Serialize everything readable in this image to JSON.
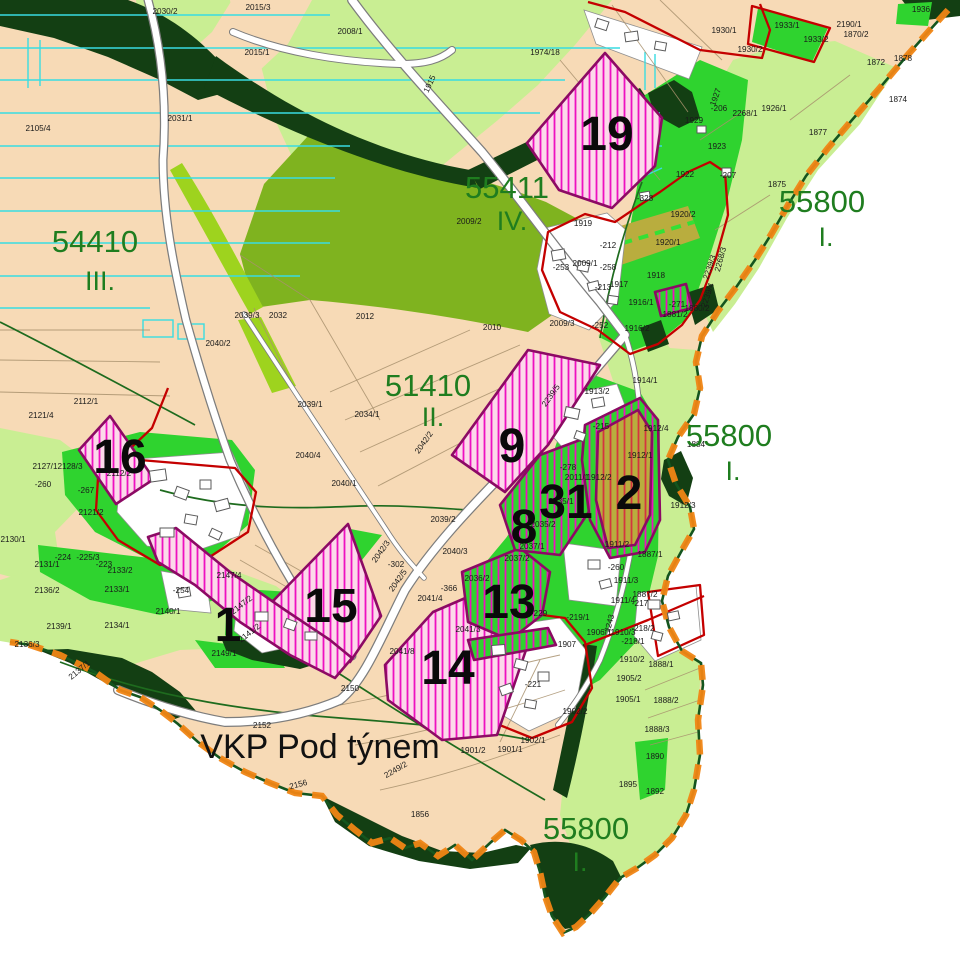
{
  "map": {
    "area_label": {
      "text": "VKP Pod týnem",
      "x": 320,
      "y": 758
    },
    "region_labels": [
      {
        "code": "54410",
        "roman": "III.",
        "x": 95,
        "y": 252,
        "rx": 100,
        "ry": 290
      },
      {
        "code": "55411",
        "roman": "IV.",
        "x": 507,
        "y": 198,
        "rx": 512,
        "ry": 230
      },
      {
        "code": "51410",
        "roman": "II.",
        "x": 428,
        "y": 396,
        "rx": 433,
        "ry": 426
      },
      {
        "code": "55800",
        "roman": "I.",
        "x": 822,
        "y": 212,
        "rx": 826,
        "ry": 246
      },
      {
        "code": "55800",
        "roman": "I.",
        "x": 729,
        "y": 446,
        "rx": 733,
        "ry": 480
      },
      {
        "code": "55800",
        "roman": "I.",
        "x": 586,
        "y": 839,
        "rx": 580,
        "ry": 871
      }
    ],
    "site_numbers": [
      {
        "n": "19",
        "x": 607,
        "y": 150
      },
      {
        "n": "16",
        "x": 120,
        "y": 473
      },
      {
        "n": "9",
        "x": 512,
        "y": 462
      },
      {
        "n": "8",
        "x": 524,
        "y": 543
      },
      {
        "n": "31",
        "x": 566,
        "y": 518
      },
      {
        "n": "2",
        "x": 629,
        "y": 509
      },
      {
        "n": "13",
        "x": 509,
        "y": 618
      },
      {
        "n": "15",
        "x": 331,
        "y": 622
      },
      {
        "n": "1",
        "x": 228,
        "y": 641
      },
      {
        "n": "14",
        "x": 448,
        "y": 684
      }
    ],
    "parcel_labels": [
      {
        "t": "2030/2",
        "x": 165,
        "y": 14
      },
      {
        "t": "2015/3",
        "x": 258,
        "y": 10
      },
      {
        "t": "2008/1",
        "x": 350,
        "y": 34
      },
      {
        "t": "2015/1",
        "x": 257,
        "y": 55
      },
      {
        "t": "1974/18",
        "x": 545,
        "y": 55
      },
      {
        "t": "2105/4",
        "x": 38,
        "y": 131
      },
      {
        "t": "2031/1",
        "x": 180,
        "y": 121
      },
      {
        "t": "1915",
        "x": 432,
        "y": 85,
        "r": -65
      },
      {
        "t": "1930/1",
        "x": 724,
        "y": 33
      },
      {
        "t": "1933/1",
        "x": 787,
        "y": 28
      },
      {
        "t": "1933/2",
        "x": 816,
        "y": 42
      },
      {
        "t": "1930/2",
        "x": 750,
        "y": 52
      },
      {
        "t": "1936",
        "x": 921,
        "y": 12
      },
      {
        "t": "2190/1",
        "x": 849,
        "y": 27
      },
      {
        "t": "1870/2",
        "x": 856,
        "y": 37
      },
      {
        "t": "1872",
        "x": 876,
        "y": 65
      },
      {
        "t": "1878",
        "x": 903,
        "y": 61
      },
      {
        "t": "1874",
        "x": 898,
        "y": 102
      },
      {
        "t": "1926/1",
        "x": 774,
        "y": 111
      },
      {
        "t": "1877",
        "x": 818,
        "y": 135
      },
      {
        "t": "1875",
        "x": 777,
        "y": 187
      },
      {
        "t": "-206",
        "x": 719,
        "y": 111
      },
      {
        "t": "2268/1",
        "x": 745,
        "y": 116
      },
      {
        "t": "1929",
        "x": 694,
        "y": 123
      },
      {
        "t": "1927",
        "x": 718,
        "y": 98,
        "r": -70
      },
      {
        "t": "1923",
        "x": 717,
        "y": 149
      },
      {
        "t": "1922",
        "x": 685,
        "y": 177
      },
      {
        "t": "-207",
        "x": 728,
        "y": 178
      },
      {
        "t": "-328",
        "x": 645,
        "y": 201
      },
      {
        "t": "1920/2",
        "x": 683,
        "y": 217
      },
      {
        "t": "1920/1",
        "x": 668,
        "y": 245
      },
      {
        "t": "1918",
        "x": 656,
        "y": 278
      },
      {
        "t": "1917",
        "x": 619,
        "y": 287
      },
      {
        "t": "-213",
        "x": 603,
        "y": 290
      },
      {
        "t": "-212",
        "x": 608,
        "y": 248
      },
      {
        "t": "-253",
        "x": 561,
        "y": 270
      },
      {
        "t": "2009/1",
        "x": 585,
        "y": 266
      },
      {
        "t": "-258",
        "x": 608,
        "y": 270
      },
      {
        "t": "1919",
        "x": 583,
        "y": 226
      },
      {
        "t": "1916/1",
        "x": 641,
        "y": 305
      },
      {
        "t": "-271",
        "x": 677,
        "y": 307
      },
      {
        "t": "1881/2",
        "x": 675,
        "y": 317
      },
      {
        "t": "1880/2",
        "x": 697,
        "y": 311
      },
      {
        "t": "-252",
        "x": 600,
        "y": 328
      },
      {
        "t": "1916/2",
        "x": 637,
        "y": 331
      },
      {
        "t": "2009/3",
        "x": 562,
        "y": 326
      },
      {
        "t": "2009/2",
        "x": 469,
        "y": 224
      },
      {
        "t": "2012",
        "x": 365,
        "y": 319
      },
      {
        "t": "2032",
        "x": 278,
        "y": 318
      },
      {
        "t": "2039/3",
        "x": 247,
        "y": 318
      },
      {
        "t": "2010",
        "x": 492,
        "y": 330
      },
      {
        "t": "2034/1",
        "x": 367,
        "y": 417
      },
      {
        "t": "2040/1",
        "x": 344,
        "y": 486
      },
      {
        "t": "2040/2",
        "x": 218,
        "y": 346
      },
      {
        "t": "2112/1",
        "x": 86,
        "y": 404
      },
      {
        "t": "2121/4",
        "x": 41,
        "y": 418
      },
      {
        "t": "2039/1",
        "x": 310,
        "y": 407
      },
      {
        "t": "2040/4",
        "x": 308,
        "y": 458
      },
      {
        "t": "2127/1",
        "x": 45,
        "y": 469
      },
      {
        "t": "2128/3",
        "x": 70,
        "y": 469
      },
      {
        "t": "2112/2",
        "x": 119,
        "y": 476
      },
      {
        "t": "-260",
        "x": 43,
        "y": 487
      },
      {
        "t": "-267",
        "x": 86,
        "y": 493
      },
      {
        "t": "2121/2",
        "x": 91,
        "y": 515
      },
      {
        "t": "2130/1",
        "x": 13,
        "y": 542
      },
      {
        "t": "-224",
        "x": 63,
        "y": 560
      },
      {
        "t": "-225/3",
        "x": 88,
        "y": 560
      },
      {
        "t": "-223",
        "x": 104,
        "y": 567
      },
      {
        "t": "2131/1",
        "x": 47,
        "y": 567
      },
      {
        "t": "2133/2",
        "x": 120,
        "y": 573
      },
      {
        "t": "2133/1",
        "x": 117,
        "y": 592
      },
      {
        "t": "2136/2",
        "x": 47,
        "y": 593
      },
      {
        "t": "2134/1",
        "x": 117,
        "y": 628
      },
      {
        "t": "2139/1",
        "x": 59,
        "y": 629
      },
      {
        "t": "2136/3",
        "x": 27,
        "y": 647
      },
      {
        "t": "2137/1",
        "x": 81,
        "y": 672,
        "r": -40
      },
      {
        "t": "2147/4",
        "x": 229,
        "y": 578
      },
      {
        "t": "-254",
        "x": 181,
        "y": 593
      },
      {
        "t": "2140/1",
        "x": 168,
        "y": 614
      },
      {
        "t": "2147/2",
        "x": 243,
        "y": 607,
        "r": -38
      },
      {
        "t": "2141/2",
        "x": 251,
        "y": 635,
        "r": -38
      },
      {
        "t": "2149/1",
        "x": 224,
        "y": 656
      },
      {
        "t": "2150",
        "x": 350,
        "y": 691
      },
      {
        "t": "2152",
        "x": 262,
        "y": 728
      },
      {
        "t": "2156",
        "x": 299,
        "y": 787,
        "r": -15
      },
      {
        "t": "1856",
        "x": 420,
        "y": 817
      },
      {
        "t": "2042/2",
        "x": 426,
        "y": 444,
        "r": -55
      },
      {
        "t": "2039/2",
        "x": 443,
        "y": 522
      },
      {
        "t": "2042/3",
        "x": 383,
        "y": 553,
        "r": -55
      },
      {
        "t": "-302",
        "x": 396,
        "y": 567
      },
      {
        "t": "2040/3",
        "x": 455,
        "y": 554
      },
      {
        "t": "-366",
        "x": 449,
        "y": 591
      },
      {
        "t": "2041/4",
        "x": 430,
        "y": 601
      },
      {
        "t": "2041/3",
        "x": 468,
        "y": 632
      },
      {
        "t": "2041/8",
        "x": 402,
        "y": 654
      },
      {
        "t": "2035/2",
        "x": 543,
        "y": 527
      },
      {
        "t": "2035/1",
        "x": 561,
        "y": 504
      },
      {
        "t": "2037/1",
        "x": 532,
        "y": 549
      },
      {
        "t": "2037/2",
        "x": 517,
        "y": 561
      },
      {
        "t": "2036/2",
        "x": 477,
        "y": 581
      },
      {
        "t": "2239/5",
        "x": 553,
        "y": 397,
        "r": -55
      },
      {
        "t": "1913/2",
        "x": 597,
        "y": 394
      },
      {
        "t": "-215",
        "x": 601,
        "y": 429
      },
      {
        "t": "-278",
        "x": 568,
        "y": 470
      },
      {
        "t": "2011/1",
        "x": 577,
        "y": 480
      },
      {
        "t": "1912/2",
        "x": 599,
        "y": 480
      },
      {
        "t": "1912/4",
        "x": 656,
        "y": 431
      },
      {
        "t": "1912/1",
        "x": 640,
        "y": 458
      },
      {
        "t": "1914/1",
        "x": 645,
        "y": 383
      },
      {
        "t": "1884",
        "x": 696,
        "y": 447
      },
      {
        "t": "1912/3",
        "x": 683,
        "y": 508
      },
      {
        "t": "1887/1",
        "x": 650,
        "y": 557
      },
      {
        "t": "1887/2",
        "x": 645,
        "y": 597
      },
      {
        "t": "2239/3",
        "x": 712,
        "y": 268,
        "r": -72
      },
      {
        "t": "2239/4",
        "x": 710,
        "y": 296,
        "r": -72
      },
      {
        "t": "2268/3",
        "x": 723,
        "y": 260,
        "r": -75
      },
      {
        "t": "2042/5",
        "x": 400,
        "y": 582,
        "r": -55
      },
      {
        "t": "1888/1",
        "x": 661,
        "y": 667
      },
      {
        "t": "1888/2",
        "x": 666,
        "y": 703
      },
      {
        "t": "1888/3",
        "x": 657,
        "y": 732
      },
      {
        "t": "1890",
        "x": 655,
        "y": 759
      },
      {
        "t": "1892",
        "x": 655,
        "y": 794
      },
      {
        "t": "1895",
        "x": 628,
        "y": 787
      },
      {
        "t": "1905/1",
        "x": 628,
        "y": 702
      },
      {
        "t": "1905/2",
        "x": 629,
        "y": 681
      },
      {
        "t": "1910/2",
        "x": 632,
        "y": 662
      },
      {
        "t": "1910/3",
        "x": 623,
        "y": 635
      },
      {
        "t": "-218/1",
        "x": 633,
        "y": 644
      },
      {
        "t": "-218/2",
        "x": 643,
        "y": 631
      },
      {
        "t": "-217",
        "x": 640,
        "y": 606
      },
      {
        "t": "1911/4",
        "x": 623,
        "y": 603
      },
      {
        "t": "1911/3",
        "x": 626,
        "y": 583
      },
      {
        "t": "1911/2",
        "x": 617,
        "y": 547
      },
      {
        "t": "-260",
        "x": 616,
        "y": 570
      },
      {
        "t": "1906/1",
        "x": 599,
        "y": 635
      },
      {
        "t": "1907",
        "x": 567,
        "y": 647
      },
      {
        "t": "-229",
        "x": 539,
        "y": 616
      },
      {
        "t": "-219/1",
        "x": 578,
        "y": 620
      },
      {
        "t": "-221",
        "x": 533,
        "y": 687
      },
      {
        "t": "2243",
        "x": 612,
        "y": 624,
        "r": -75
      },
      {
        "t": "1902/2",
        "x": 575,
        "y": 714
      },
      {
        "t": "1902/1",
        "x": 533,
        "y": 743
      },
      {
        "t": "1901/2",
        "x": 473,
        "y": 753
      },
      {
        "t": "1901/1",
        "x": 510,
        "y": 752
      },
      {
        "t": "2249/2",
        "x": 397,
        "y": 772,
        "r": -30
      }
    ],
    "colors": {
      "beige": "#f7dab6",
      "light_green": "#c9ee93",
      "mid_green": "#7fb31f",
      "bright_green": "#2fd32f",
      "dark_green": "#133f13",
      "lime": "#9ed31e",
      "olive": "#b9ad3e",
      "pink_bg": "#fcd9ea",
      "hatch_magenta": "#ee10c0",
      "hatch_red": "#d4353f",
      "purple": "#8c0a64",
      "red": "#c40000",
      "orange": "#f08514",
      "cyan": "#39dce2",
      "label_green": "#1f7d1f"
    }
  }
}
